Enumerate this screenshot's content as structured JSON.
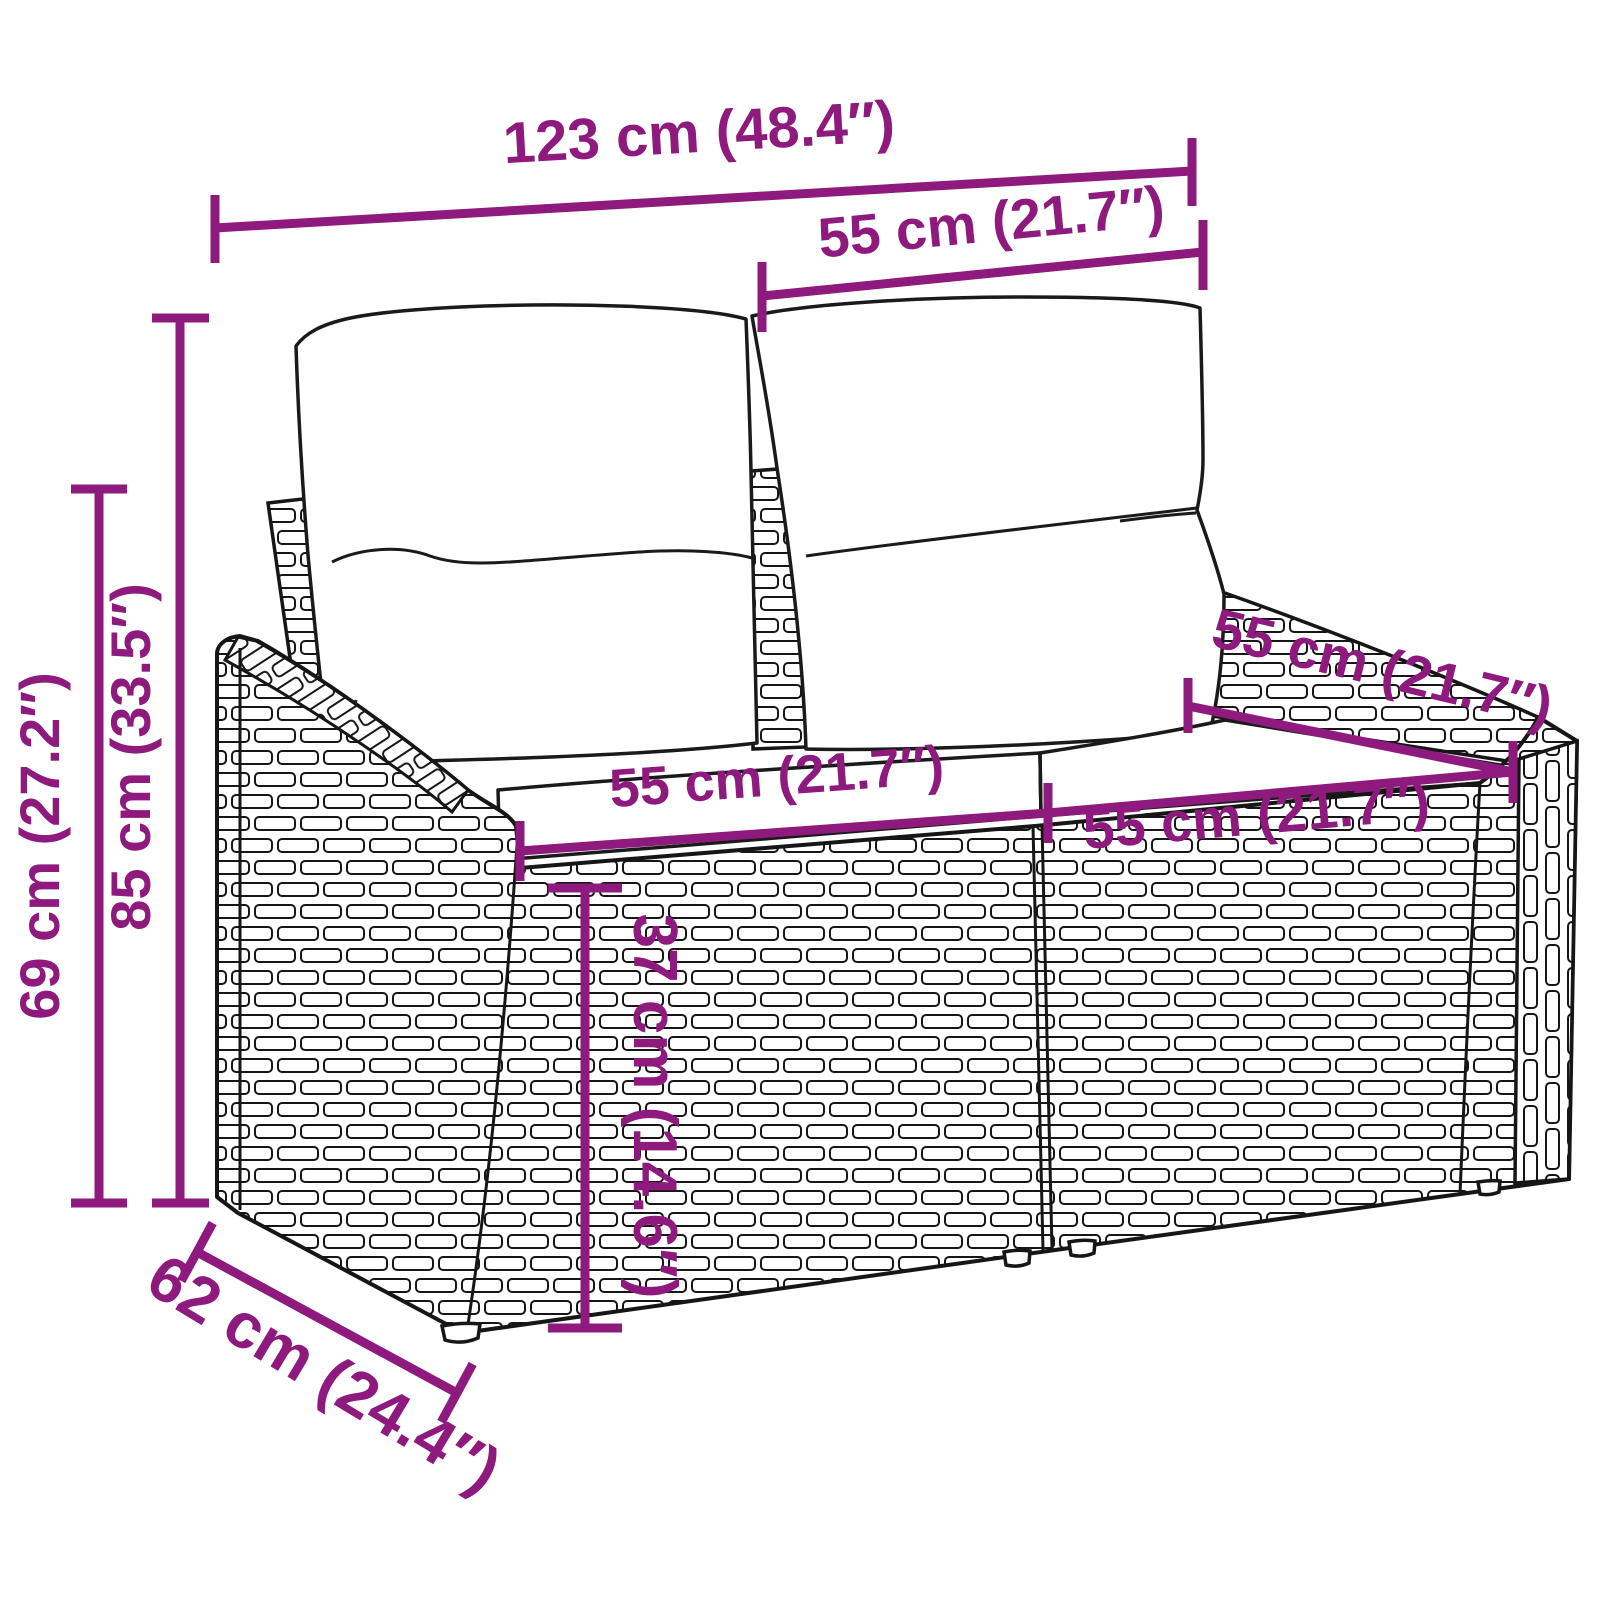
{
  "diagram": {
    "kind": "product-dimension-diagram",
    "subject": "Poly rattan 2-seater garden sofa line drawing with two back cushions and two seat cushions",
    "background_color": "#FFFFFF",
    "line_art_color": "#1A1A1A",
    "accent_color": "#8E1A7E",
    "dimensions": [
      {
        "name": "overall-width",
        "cm": 123,
        "inches": 48.4,
        "label": "123 cm (48.4″)"
      },
      {
        "name": "backrest-section-width",
        "cm": 55,
        "inches": 21.7,
        "label": "55 cm (21.7″)"
      },
      {
        "name": "overall-height",
        "cm": 85,
        "inches": 33.5,
        "label": "85 cm (33.5″)"
      },
      {
        "name": "armrest-height",
        "cm": 69,
        "inches": 27.2,
        "label": "69 cm (27.2″)"
      },
      {
        "name": "depth",
        "cm": 62,
        "inches": 24.4,
        "label": "62 cm (24.4″)"
      },
      {
        "name": "seat-depth",
        "cm": 55,
        "inches": 21.7,
        "label": "55 cm (21.7″)"
      },
      {
        "name": "seat-width-left",
        "cm": 55,
        "inches": 21.7,
        "label": "55 cm (21.7″)"
      },
      {
        "name": "seat-width-right",
        "cm": 55,
        "inches": 21.7,
        "label": "55 cm (21.7″)"
      },
      {
        "name": "seat-height",
        "cm": 37,
        "inches": 14.6,
        "label": "37 cm (14.6″)"
      }
    ]
  }
}
